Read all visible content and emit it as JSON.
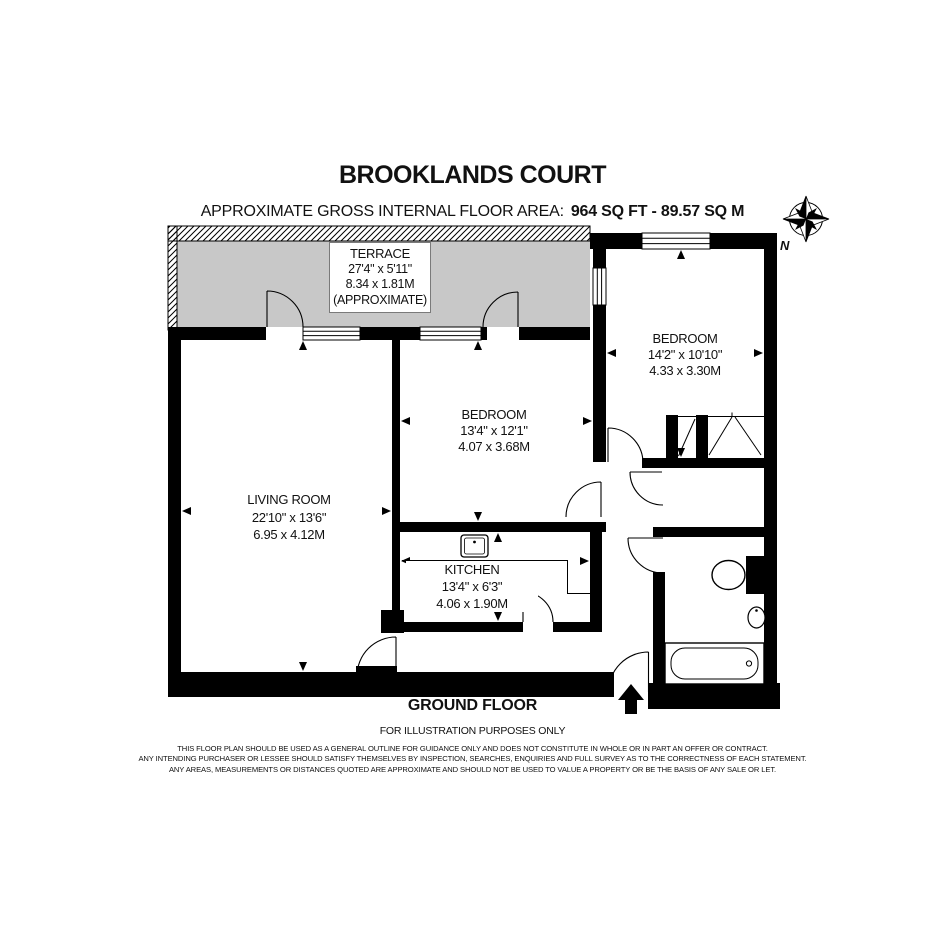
{
  "header": {
    "title": "BROOKLANDS COURT",
    "area_label": "APPROXIMATE GROSS INTERNAL FLOOR AREA:",
    "area_value": "964 SQ FT - 89.57 SQ M"
  },
  "rooms": {
    "terrace": {
      "name": "TERRACE",
      "imperial": "27'4\" x 5'11\"",
      "metric": "8.34 x 1.81M",
      "note": "(APPROXIMATE)"
    },
    "bedroom1": {
      "name": "BEDROOM",
      "imperial": "14'2\" x 10'10\"",
      "metric": "4.33 x 3.30M"
    },
    "bedroom2": {
      "name": "BEDROOM",
      "imperial": "13'4\" x 12'1\"",
      "metric": "4.07 x 3.68M"
    },
    "living_room": {
      "name": "LIVING ROOM",
      "imperial": "22'10\" x 13'6\"",
      "metric": "6.95 x 4.12M"
    },
    "kitchen": {
      "name": "KITCHEN",
      "imperial": "13'4\" x 6'3\"",
      "metric": "4.06 x 1.90M"
    }
  },
  "footer": {
    "floor_label": "GROUND FLOOR",
    "illustration_note": "FOR ILLUSTRATION PURPOSES ONLY",
    "disclaimer": [
      "THIS FLOOR PLAN SHOULD BE USED AS A GENERAL OUTLINE FOR GUIDANCE ONLY AND DOES NOT CONSTITUTE IN WHOLE OR IN PART AN OFFER OR CONTRACT.",
      "ANY INTENDING PURCHASER OR LESSEE SHOULD SATISFY THEMSELVES BY INSPECTION, SEARCHES, ENQUIRIES AND FULL SURVEY AS TO THE CORRECTNESS OF EACH STATEMENT.",
      "ANY AREAS, MEASUREMENTS OR DISTANCES QUOTED ARE APPROXIMATE AND SHOULD NOT BE USED TO VALUE A PROPERTY OR BE THE BASIS OF ANY SALE OR LET."
    ]
  },
  "compass": {
    "north_label": "N"
  },
  "colors": {
    "wall": "#000000",
    "terrace_fill": "#c8c8c8",
    "text": "#111111"
  }
}
